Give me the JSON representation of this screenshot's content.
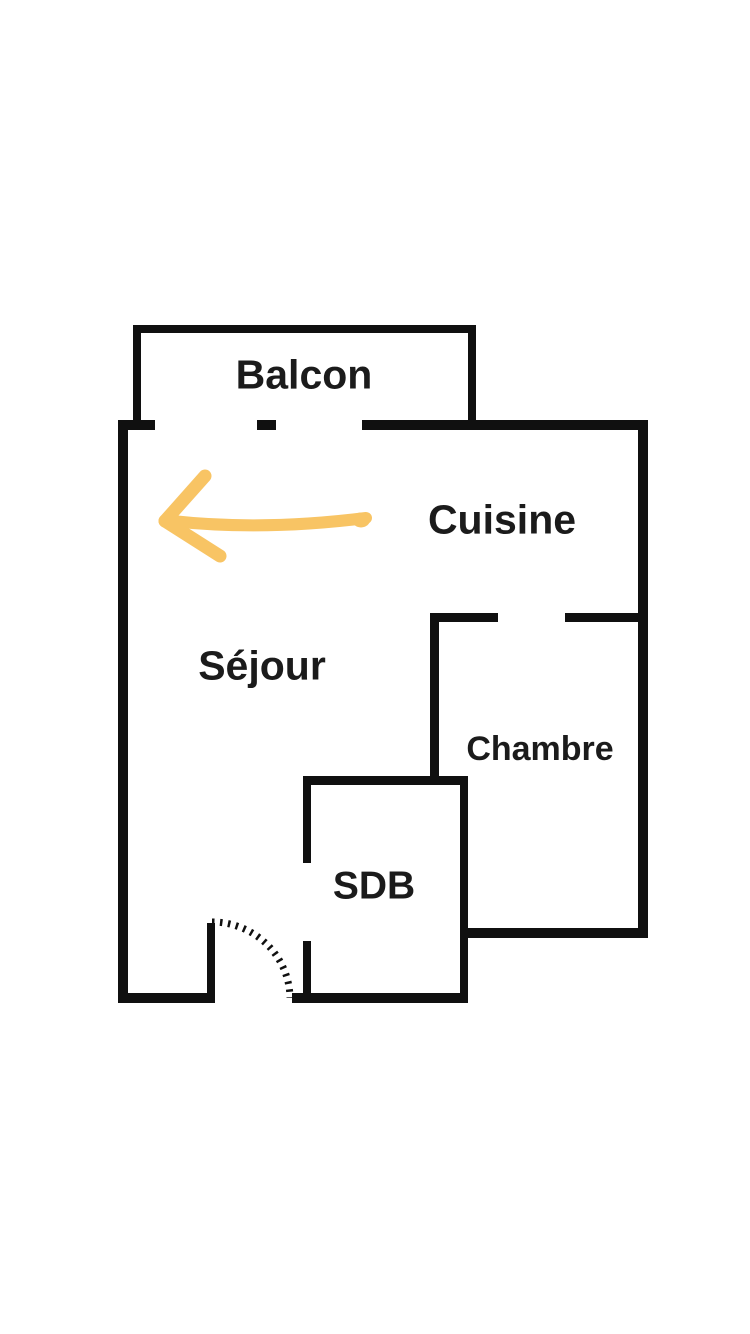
{
  "page": {
    "background": "#ffffff"
  },
  "colors": {
    "wall": "#101010",
    "text": "#1b1b1b",
    "arrow": "#F8C464"
  },
  "rooms": [
    {
      "id": "balcon",
      "label": "Balcon"
    },
    {
      "id": "cuisine",
      "label": "Cuisine"
    },
    {
      "id": "sejour",
      "label": "Séjour"
    },
    {
      "id": "chambre",
      "label": "Chambre"
    },
    {
      "id": "sdb",
      "label": "SDB"
    }
  ],
  "overlay": {
    "arrow_direction": "left"
  }
}
